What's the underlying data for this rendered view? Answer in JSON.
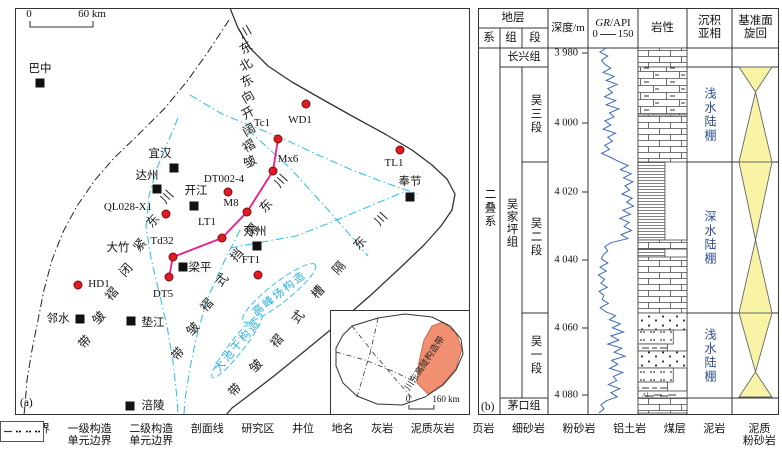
{
  "panel_a": {
    "tag": "(a)",
    "scalebar": {
      "left": "0",
      "right": "60 km"
    },
    "cities": [
      {
        "name": "巴中",
        "lx": 40,
        "ly": 68,
        "sx": 40,
        "sy": 83
      },
      {
        "name": "宜汉",
        "lx": 160,
        "ly": 153,
        "sx": 174,
        "sy": 168
      },
      {
        "name": "达州",
        "lx": 147,
        "ly": 175,
        "sx": 157,
        "sy": 189
      },
      {
        "name": "开江",
        "lx": 196,
        "ly": 190,
        "sx": 194,
        "sy": 206
      },
      {
        "name": "万州",
        "lx": 255,
        "ly": 231,
        "sx": 257,
        "sy": 246
      },
      {
        "name": "奉节",
        "lx": 410,
        "ly": 181,
        "sx": 410,
        "sy": 197
      },
      {
        "name": "梁平",
        "lx": 200,
        "ly": 267,
        "sx": 183,
        "sy": 267
      },
      {
        "name": "邻水",
        "lx": 58,
        "ly": 318,
        "sx": 80,
        "sy": 319
      },
      {
        "name": "垫江",
        "lx": 153,
        "ly": 322,
        "sx": 131,
        "sy": 321
      },
      {
        "name": "涪陵",
        "lx": 153,
        "ly": 405,
        "sx": 130,
        "sy": 406
      }
    ],
    "places": [
      {
        "name": "大竹",
        "x": 118,
        "y": 247
      }
    ],
    "wells": [
      {
        "name": "QL028-X1",
        "dx": 166,
        "dy": 214,
        "lx": 128,
        "ly": 207
      },
      {
        "name": "HD1",
        "dx": 78,
        "dy": 285,
        "lx": 99,
        "ly": 284
      },
      {
        "name": "DT5",
        "dx": 169,
        "dy": 277,
        "lx": 163,
        "ly": 294
      },
      {
        "name": "Td32",
        "dx": 173,
        "dy": 257,
        "lx": 162,
        "ly": 241
      },
      {
        "name": "LT1",
        "dx": 222,
        "dy": 238,
        "lx": 207,
        "ly": 222
      },
      {
        "name": "M8",
        "dx": 247,
        "dy": 212,
        "lx": 231,
        "ly": 203
      },
      {
        "name": "DT002-4",
        "dx": 228,
        "dy": 192,
        "lx": 224,
        "ly": 179
      },
      {
        "name": "Mx6",
        "dx": 273,
        "dy": 171,
        "lx": 288,
        "ly": 159
      },
      {
        "name": "Tc1",
        "dx": 278,
        "dy": 139,
        "lx": 262,
        "ly": 123
      },
      {
        "name": "WD1",
        "dx": 306,
        "dy": 104,
        "lx": 300,
        "ly": 120
      },
      {
        "name": "TL1",
        "dx": 400,
        "dy": 150,
        "lx": 394,
        "ly": 163
      },
      {
        "name": "FT1",
        "dx": 258,
        "dy": 275,
        "lx": 251,
        "ly": 260
      }
    ],
    "profile": [
      [
        169,
        277
      ],
      [
        173,
        257
      ],
      [
        222,
        238
      ],
      [
        247,
        212
      ],
      [
        273,
        171
      ],
      [
        278,
        139
      ]
    ],
    "fold_labels": [
      {
        "text": "川东北东向开阔褶皱",
        "x1": 245,
        "y1": 32,
        "x2": 250,
        "y2": 162,
        "rot": -30
      },
      {
        "text": "川东紧闭褶皱带",
        "x1": 167,
        "y1": 197,
        "x2": 85,
        "y2": 342,
        "rot": -48
      },
      {
        "text": "川东隔挡式褶皱带",
        "x1": 281,
        "y1": 181,
        "x2": 178,
        "y2": 354,
        "rot": -48
      },
      {
        "text": "川东隔槽式褶皱带",
        "x1": 381,
        "y1": 219,
        "x2": 235,
        "y2": 390,
        "rot": -48
      }
    ],
    "blue_labels": [
      {
        "text": "高峰场构造",
        "x": 279,
        "y": 293,
        "rot": -38
      },
      {
        "text": "大池干构造",
        "x": 237,
        "y": 345,
        "rot": -50
      }
    ],
    "boundaries": {
      "basin": [
        [
          230,
          8
        ],
        [
          238,
          28
        ],
        [
          250,
          48
        ],
        [
          268,
          66
        ],
        [
          292,
          82
        ],
        [
          320,
          98
        ],
        [
          352,
          116
        ],
        [
          385,
          134
        ],
        [
          412,
          150
        ],
        [
          432,
          165
        ],
        [
          447,
          179
        ],
        [
          455,
          194
        ],
        [
          452,
          210
        ],
        [
          441,
          226
        ],
        [
          424,
          245
        ],
        [
          400,
          268
        ],
        [
          372,
          294
        ],
        [
          340,
          322
        ],
        [
          306,
          350
        ],
        [
          274,
          376
        ],
        [
          248,
          396
        ],
        [
          232,
          408
        ],
        [
          226,
          415
        ]
      ],
      "first_order": [
        [
          229,
          20
        ],
        [
          208,
          52
        ],
        [
          188,
          80
        ],
        [
          165,
          108
        ],
        [
          138,
          135
        ],
        [
          114,
          158
        ],
        [
          95,
          180
        ],
        [
          77,
          206
        ],
        [
          63,
          232
        ],
        [
          52,
          260
        ],
        [
          44,
          290
        ],
        [
          38,
          320
        ],
        [
          32,
          350
        ],
        [
          27,
          380
        ],
        [
          25,
          405
        ],
        [
          24,
          415
        ]
      ],
      "second_order": [
        [
          [
            178,
            118
          ],
          [
            168,
            142
          ],
          [
            157,
            168
          ],
          [
            149,
            196
          ],
          [
            146,
            226
          ],
          [
            151,
            258
          ],
          [
            159,
            292
          ],
          [
            167,
            326
          ],
          [
            173,
            362
          ],
          [
            177,
            398
          ],
          [
            178,
            414
          ]
        ],
        [
          [
            190,
            95
          ],
          [
            222,
            114
          ],
          [
            254,
            127
          ],
          [
            286,
            140
          ],
          [
            318,
            155
          ],
          [
            352,
            170
          ],
          [
            386,
            183
          ],
          [
            418,
            194
          ]
        ],
        [
          [
            248,
            130
          ],
          [
            268,
            148
          ],
          [
            290,
            168
          ],
          [
            310,
            190
          ],
          [
            330,
            212
          ],
          [
            350,
            235
          ],
          [
            368,
            256
          ]
        ],
        [
          [
            230,
            248
          ],
          [
            262,
            242
          ],
          [
            296,
            236
          ],
          [
            332,
            222
          ],
          [
            370,
            206
          ],
          [
            406,
            191
          ]
        ],
        [
          [
            240,
            230
          ],
          [
            224,
            262
          ],
          [
            209,
            295
          ],
          [
            198,
            330
          ],
          [
            190,
            368
          ],
          [
            185,
            400
          ],
          [
            184,
            414
          ]
        ]
      ],
      "ellipses": [
        {
          "cx": 279,
          "cy": 293,
          "rx": 46,
          "ry": 10,
          "rot": -38
        },
        {
          "cx": 237,
          "cy": 346,
          "rx": 40,
          "ry": 7,
          "rot": -52
        }
      ]
    },
    "inset": {
      "label": "川东高陡构造带",
      "scale": {
        "left": "0",
        "right": "160 km"
      },
      "outline": [
        [
          352,
          326
        ],
        [
          378,
          318
        ],
        [
          405,
          314
        ],
        [
          432,
          317
        ],
        [
          450,
          326
        ],
        [
          461,
          339
        ],
        [
          463,
          354
        ],
        [
          456,
          370
        ],
        [
          443,
          385
        ],
        [
          425,
          397
        ],
        [
          402,
          405
        ],
        [
          377,
          404
        ],
        [
          357,
          396
        ],
        [
          343,
          383
        ],
        [
          336,
          366
        ],
        [
          336,
          348
        ],
        [
          343,
          335
        ]
      ],
      "study": [
        [
          443,
          322
        ],
        [
          456,
          333
        ],
        [
          462,
          349
        ],
        [
          456,
          368
        ],
        [
          443,
          384
        ],
        [
          428,
          394
        ],
        [
          417,
          383
        ],
        [
          419,
          362
        ],
        [
          424,
          340
        ],
        [
          432,
          326
        ]
      ],
      "inner_lines": [
        [
          [
            352,
            326
          ],
          [
            375,
            355
          ],
          [
            398,
            382
          ],
          [
            412,
            398
          ]
        ],
        [
          [
            378,
            318
          ],
          [
            371,
            350
          ],
          [
            362,
            380
          ],
          [
            357,
            397
          ]
        ],
        [
          [
            336,
            352
          ],
          [
            365,
            360
          ],
          [
            395,
            372
          ],
          [
            417,
            383
          ]
        ]
      ]
    }
  },
  "legend": [
    {
      "label": "盆地边界",
      "type": "basin"
    },
    {
      "label": "一级构造\n单元边界",
      "type": "dashdot-black"
    },
    {
      "label": "二级构造\n单元边界",
      "type": "dashdot-cyan"
    },
    {
      "label": "剖面线",
      "type": "profile"
    },
    {
      "label": "研究区",
      "type": "study"
    },
    {
      "label": "井位",
      "type": "well"
    },
    {
      "label": "地名",
      "type": "place"
    },
    {
      "label": "灰岩",
      "type": "lime"
    },
    {
      "label": "泥质灰岩",
      "type": "arglime"
    },
    {
      "label": "页岩",
      "type": "shale"
    },
    {
      "label": "细砂岩",
      "type": "finesand"
    },
    {
      "label": "粉砂岩",
      "type": "silt"
    },
    {
      "label": "铝土岩",
      "type": "bauxite"
    },
    {
      "label": "煤层",
      "type": "coal"
    },
    {
      "label": "泥岩",
      "type": "mud"
    },
    {
      "label": "泥质\n粉砂岩",
      "type": "argsilt"
    }
  ],
  "panel_b": {
    "tag": "(b)",
    "headers": {
      "strata": "地层",
      "series_col": "系",
      "formation_col": "组",
      "member_col": "段",
      "depth": "深度/m",
      "gr_italic": "GR",
      "gr_rest": "/API",
      "gr_min": "0",
      "gr_max": "150",
      "lithology": "岩性",
      "facies": "沉积\n亚相",
      "cycle": "基准面\n旋回"
    },
    "series": "二叠系",
    "formation": "吴家坪组",
    "top_formation": "长兴组",
    "bottom_formation": "茅口组",
    "members": [
      {
        "name": "吴三段",
        "top": 59,
        "bottom": 154
      },
      {
        "name": "吴二段",
        "top": 154,
        "bottom": 305
      },
      {
        "name": "吴一段",
        "top": 305,
        "bottom": 390
      }
    ],
    "depth_ticks": [
      {
        "label": "3 980",
        "y": 45
      },
      {
        "label": "4 000",
        "y": 115
      },
      {
        "label": "4 020",
        "y": 184
      },
      {
        "label": "4 040",
        "y": 252
      },
      {
        "label": "4 060",
        "y": 320
      },
      {
        "label": "4 080",
        "y": 387
      }
    ],
    "gr_values": [
      55,
      35,
      60,
      40,
      50,
      70,
      45,
      80,
      55,
      90,
      60,
      75,
      50,
      85,
      55,
      95,
      65,
      80,
      50,
      70,
      45,
      85,
      60,
      75,
      50,
      65,
      40,
      70,
      95,
      125,
      100,
      135,
      110,
      140,
      115,
      130,
      105,
      138,
      120,
      142,
      108,
      132,
      98,
      128,
      112,
      136,
      102,
      124,
      70,
      50,
      60,
      45,
      40,
      60,
      35,
      55,
      30,
      50,
      38,
      58,
      32,
      48,
      42,
      62,
      36,
      52,
      85,
      65,
      100,
      75,
      110,
      70,
      95,
      60,
      105,
      80,
      115,
      72,
      92,
      66,
      108,
      78,
      88,
      62,
      98,
      70,
      90,
      55,
      38,
      48,
      32
    ],
    "gr_top": 40,
    "gr_bottom": 405,
    "lithology": [
      {
        "top": 40,
        "bottom": 59,
        "type": "lime",
        "w": 1
      },
      {
        "top": 59,
        "bottom": 107,
        "type": "arglime",
        "w": 1
      },
      {
        "top": 107,
        "bottom": 154,
        "type": "lime",
        "w": 1
      },
      {
        "top": 154,
        "bottom": 232,
        "type": "shale",
        "w": 0.55
      },
      {
        "top": 232,
        "bottom": 241,
        "type": "lime",
        "w": 1
      },
      {
        "top": 241,
        "bottom": 249,
        "type": "shale",
        "w": 0.55
      },
      {
        "top": 249,
        "bottom": 305,
        "type": "lime",
        "w": 1
      },
      {
        "top": 305,
        "bottom": 322,
        "type": "finesand",
        "w": 1
      },
      {
        "top": 322,
        "bottom": 336,
        "type": "silt",
        "w": 0.72
      },
      {
        "top": 336,
        "bottom": 343,
        "type": "mud",
        "w": 0.6
      },
      {
        "top": 343,
        "bottom": 360,
        "type": "finesand",
        "w": 1
      },
      {
        "top": 360,
        "bottom": 374,
        "type": "silt",
        "w": 0.72
      },
      {
        "top": 374,
        "bottom": 383,
        "type": "mud",
        "w": 0.6
      },
      {
        "top": 383,
        "bottom": 390,
        "type": "bauxite",
        "w": 1
      },
      {
        "top": 390,
        "bottom": 405,
        "type": "lime",
        "w": 1
      }
    ],
    "facies": [
      {
        "label": "浅水陆棚",
        "top": 59,
        "bottom": 154
      },
      {
        "label": "深水陆棚",
        "top": 154,
        "bottom": 305
      },
      {
        "label": "浅水陆棚",
        "top": 305,
        "bottom": 390
      }
    ],
    "cycles": [
      {
        "top": 59,
        "cross": 84,
        "bottom": 154
      },
      {
        "top": 154,
        "cross": 232,
        "bottom": 305
      },
      {
        "top": 305,
        "cross": 364,
        "bottom": 389
      }
    ],
    "colors": {
      "cyan": "#3ac0ec",
      "pink": "#ec1a8c",
      "red": "#e11b22",
      "orange": "#f09070",
      "yellow": "#f9f3a6",
      "gr_blue": "#3a6ab8",
      "facies_blue": "#2d4d8e"
    }
  }
}
